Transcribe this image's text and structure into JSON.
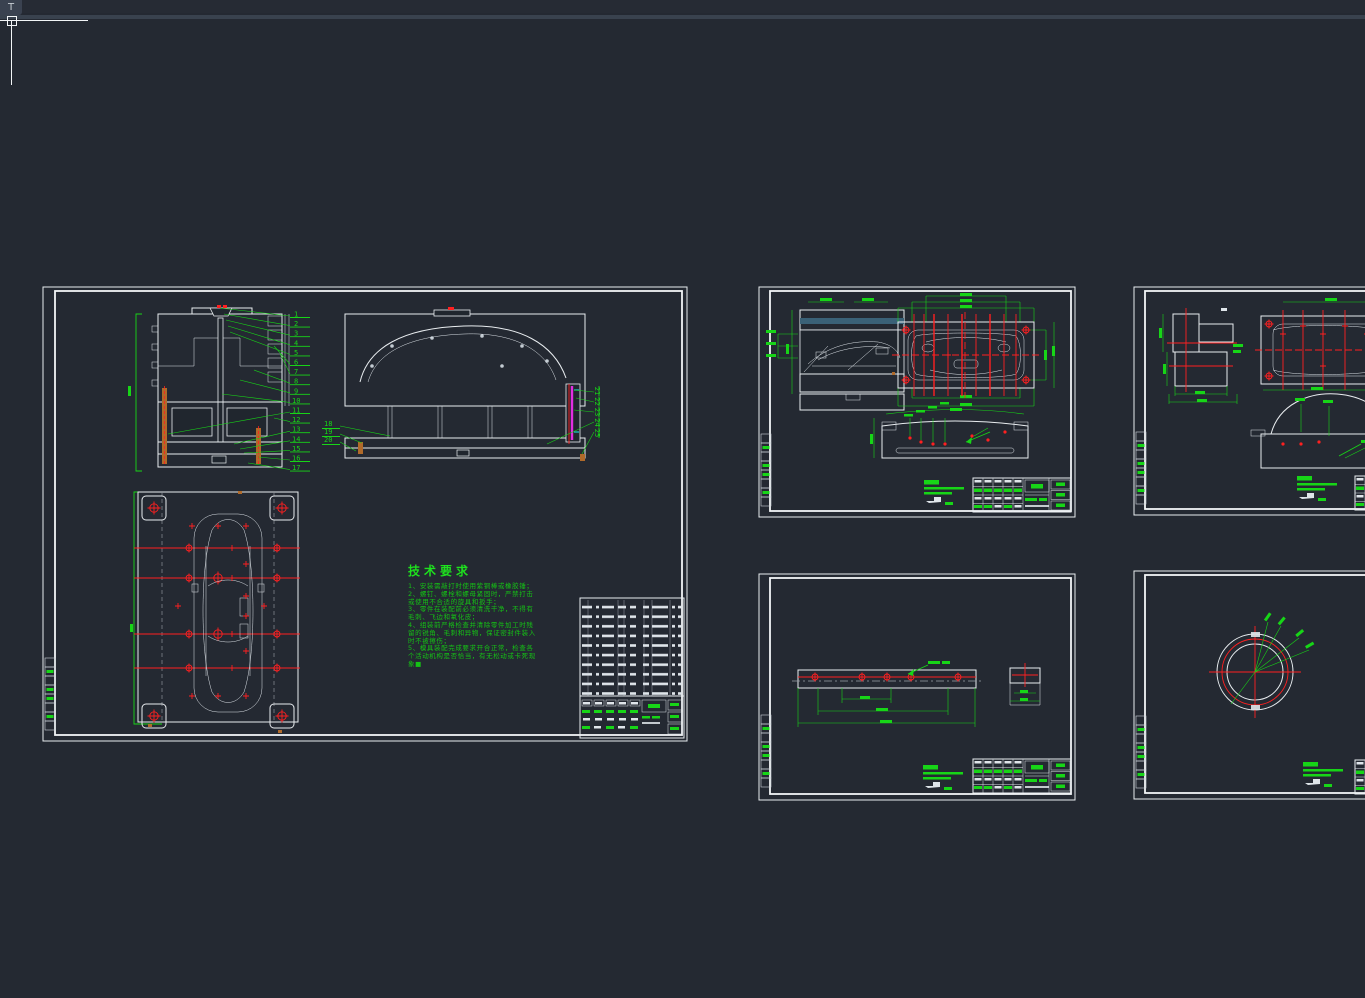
{
  "window": {
    "topbar_icon": "T"
  },
  "colors": {
    "canvas": "#242932",
    "titlebar": "#262b34",
    "toolstrip": "#39424e",
    "line_white": "#e9edf0",
    "annotation_green": "#17d517",
    "centerline_red": "#ff2020",
    "hatch_base": "#33576a",
    "hatch_line": "#7fb7cf",
    "pin_copper": "#b06a2a",
    "rod_magenta": "#e22ee2",
    "tick_cyan": "#19c8c8",
    "phantom_gray": "#9aa0a6"
  },
  "sheet_assembly": {
    "tech": {
      "title": "技术要求",
      "lines": [
        "1、安装需敲打时使用紫铜棒或橡胶锤；",
        "2、螺钉、螺栓和螺母紧固时，严禁打击",
        "或使用不合适的旋具和扳手；",
        "3、零件在装配前必须清洗干净，不得有",
        "毛刺、飞边和氧化皮；",
        "4、组装前严格检查并清除零件加工时残",
        "留的锐角、毛刺和异物，保证密封件装入",
        "时不被擦伤；",
        "5、模具装配完成要求开合正常，检查各",
        "个活动机构是否恰当，有无松动或卡死现",
        "象■"
      ]
    },
    "balloons": {
      "a": [
        "1",
        "2",
        "3",
        "4",
        "5",
        "6",
        "7",
        "8",
        "9",
        "10",
        "11",
        "12",
        "13",
        "14",
        "15",
        "16",
        "17"
      ],
      "b_left": [
        "18",
        "19",
        "20"
      ],
      "b_right": [
        "21",
        "22",
        "23",
        "24",
        "25"
      ]
    }
  }
}
